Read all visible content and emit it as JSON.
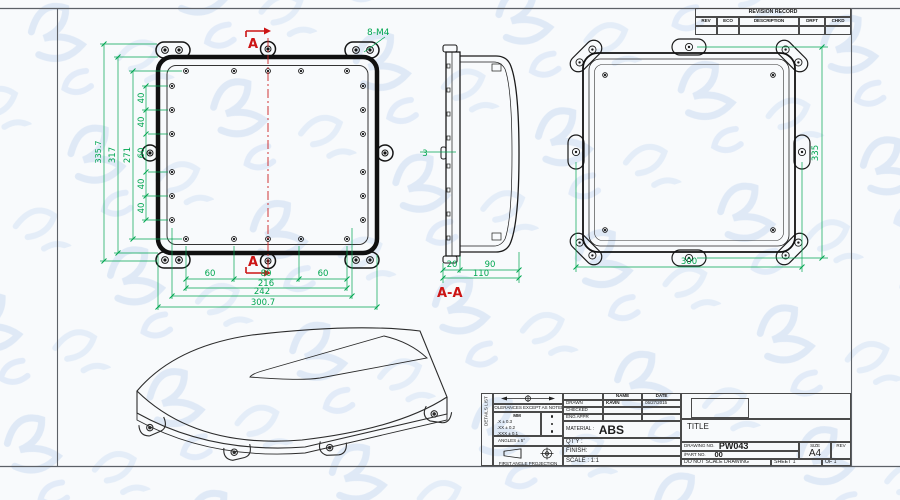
{
  "revision_table": {
    "title": "REVISION RECORD",
    "columns": {
      "rev": "REV",
      "eco": "ECO",
      "description": "DESCRIPTION",
      "drft": "DRFT",
      "chkd": "CHKD"
    }
  },
  "views": {
    "front": {
      "thread_callout": "8-M4",
      "section_letter_top": "A",
      "section_letter_bottom": "A",
      "left_chain": {
        "v40_1": "40",
        "v40_2": "40",
        "v60": "60",
        "v40_3": "40",
        "v40_4": "40"
      },
      "overall": {
        "d271": "271",
        "d317": "317",
        "d335_7": "335.7"
      },
      "bottom_chain": {
        "h60_left": "60",
        "h80": "80",
        "h60_right": "60",
        "d216": "216",
        "d242": "242",
        "d300_7": "300.7"
      }
    },
    "section": {
      "label": "A-A",
      "d3": "3",
      "d20": "20",
      "d90": "90",
      "d110": "110"
    },
    "back": {
      "d335": "335",
      "d300": "300"
    }
  },
  "title_block": {
    "side_label": "DETAILS LIST",
    "tolerances": {
      "heading": "TOLERANCES EXCEPT AS NOTED",
      "unit": "MM",
      "row1": ".X ± 0.3",
      "row2": ".XX ± 0.2",
      "row3": ".XXX ± 0.1",
      "angles": "ANGLES ± 5°",
      "projection_caption": "FIRST ANGLE PROJECTION"
    },
    "approvals": {
      "name_header": "NAME",
      "date_header": "DATE",
      "drawn_label": "DRAWN",
      "drawn_name": "KAVIN",
      "drawn_date": "05/27/2015",
      "checked_label": "CHECKED",
      "eng_appr_label": "ENG APPR"
    },
    "material_label": "MATERIAL :",
    "material_value": "ABS",
    "qty_label": "QT'Y :",
    "finish_label": "FINISH:",
    "scale_label": "SCALE : 1:1",
    "title_label": "TITLE",
    "drawing_no_label": "DRAWING NO.",
    "drawing_no_value": "PW043",
    "part_no_label": "/PART NO.",
    "part_no_value": "00",
    "size_label": "SIZE",
    "size_value": "A4",
    "rev_label": "REV",
    "do_not_scale": "DO NOT SCALE DRAWING",
    "sheet_text": "SHEET 1",
    "of_text": "OF 1"
  }
}
